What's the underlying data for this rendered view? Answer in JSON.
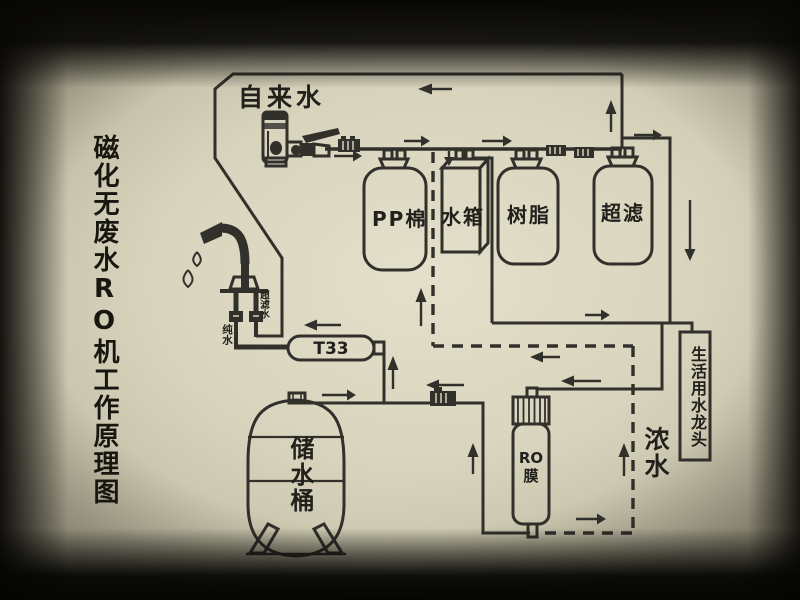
{
  "title": "磁化无废水RO机工作原理图",
  "labels": {
    "tap_water": "自来水",
    "pp_cotton": "PP棉",
    "water_tank": "水箱",
    "resin": "树脂",
    "ultra_filter": "超滤",
    "t33": "T33",
    "storage_bucket": "储水桶",
    "ro_line1": "RO",
    "ro_line2": "膜",
    "domestic_faucet": "生活用水龙头",
    "concentrate_water": "浓水",
    "pure_water": "纯水",
    "uf_water": "超滤水"
  },
  "colors": {
    "paper": "#d6d2bb",
    "line": "#31302b",
    "text": "#21201b",
    "photo_border": "#0a0908"
  }
}
